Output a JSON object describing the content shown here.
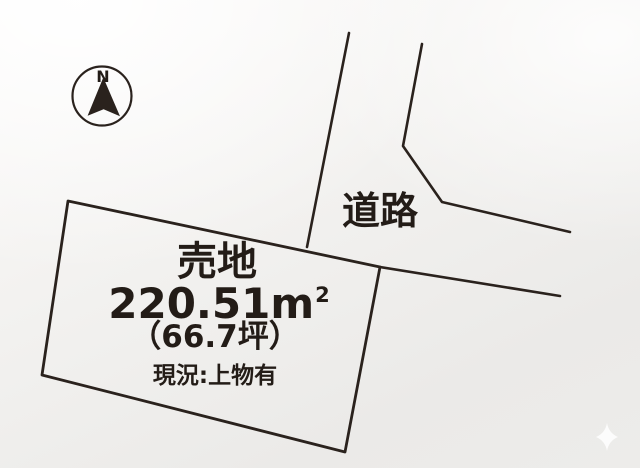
{
  "compass": {
    "north_label": "N"
  },
  "road": {
    "label": "道路"
  },
  "plot": {
    "title": "売地",
    "area_sqm": "220.51m",
    "area_sqm_sup": "2",
    "area_tsubo": "（66.7坪）",
    "status": "現況:上物有"
  },
  "colors": {
    "line": "#2a221d",
    "text": "#231c17",
    "paper_light": "#fbfaf9",
    "paper_dark": "#ebeae8"
  }
}
